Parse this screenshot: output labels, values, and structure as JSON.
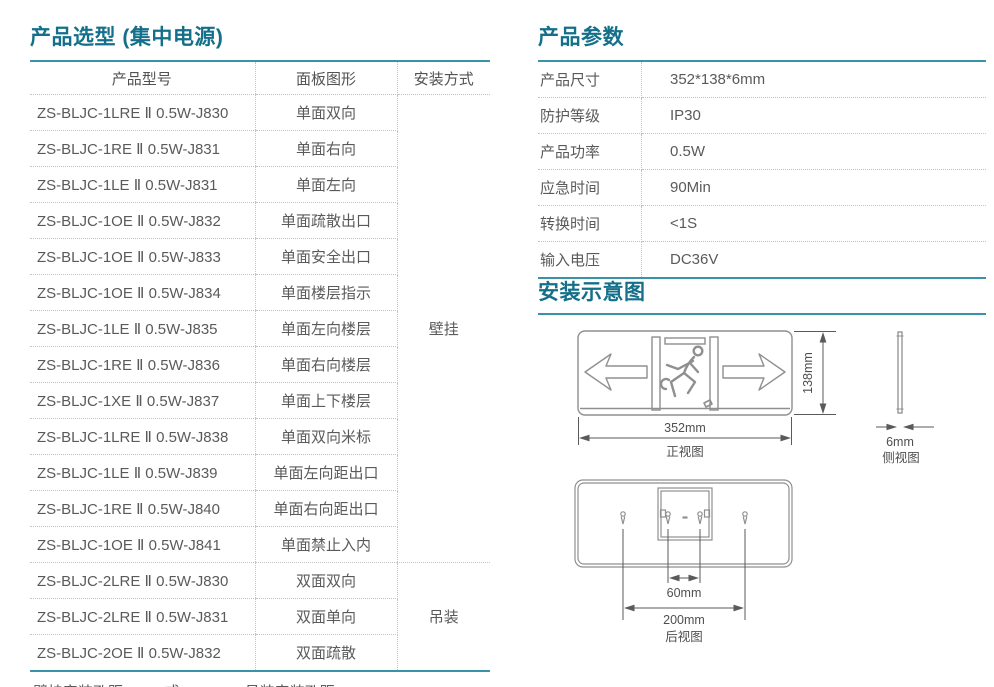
{
  "accent": {
    "title_color": "#14708a",
    "rule_color": "#3a92a8"
  },
  "selection": {
    "title": "产品选型 (集中电源)",
    "columns": [
      "产品型号",
      "面板图形",
      "安装方式"
    ],
    "rows": [
      {
        "model": "ZS-BLJC-1LRE Ⅱ 0.5W-J830",
        "panel": "单面双向"
      },
      {
        "model": "ZS-BLJC-1RE Ⅱ 0.5W-J831",
        "panel": "单面右向"
      },
      {
        "model": "ZS-BLJC-1LE Ⅱ 0.5W-J831",
        "panel": "单面左向"
      },
      {
        "model": "ZS-BLJC-1OE Ⅱ 0.5W-J832",
        "panel": "单面疏散出口"
      },
      {
        "model": "ZS-BLJC-1OE Ⅱ 0.5W-J833",
        "panel": "单面安全出口"
      },
      {
        "model": "ZS-BLJC-1OE Ⅱ 0.5W-J834",
        "panel": "单面楼层指示"
      },
      {
        "model": "ZS-BLJC-1LE Ⅱ 0.5W-J835",
        "panel": "单面左向楼层"
      },
      {
        "model": "ZS-BLJC-1RE Ⅱ 0.5W-J836",
        "panel": "单面右向楼层"
      },
      {
        "model": "ZS-BLJC-1XE Ⅱ 0.5W-J837",
        "panel": "单面上下楼层"
      },
      {
        "model": "ZS-BLJC-1LRE Ⅱ 0.5W-J838",
        "panel": "单面双向米标"
      },
      {
        "model": "ZS-BLJC-1LE Ⅱ 0.5W-J839",
        "panel": "单面左向距出口"
      },
      {
        "model": "ZS-BLJC-1RE Ⅱ 0.5W-J840",
        "panel": "单面右向距出口"
      },
      {
        "model": "ZS-BLJC-1OE Ⅱ 0.5W-J841",
        "panel": "单面禁止入内"
      },
      {
        "model": "ZS-BLJC-2LRE Ⅱ 0.5W-J830",
        "panel": "双面双向"
      },
      {
        "model": "ZS-BLJC-2LRE Ⅱ 0.5W-J831",
        "panel": "双面单向"
      },
      {
        "model": "ZS-BLJC-2OE Ⅱ 0.5W-J832",
        "panel": "双面疏散"
      }
    ],
    "mount_groups": [
      {
        "label": "壁挂",
        "span": 13
      },
      {
        "label": "吊装",
        "span": 3
      }
    ],
    "footnote": "壁挂安装孔距60mm或200mm；吊装安装孔距230mm"
  },
  "parameters": {
    "title": "产品参数",
    "rows": [
      {
        "label": "产品尺寸",
        "value": "352*138*6mm"
      },
      {
        "label": "防护等级",
        "value": "IP30"
      },
      {
        "label": "产品功率",
        "value": "0.5W"
      },
      {
        "label": "应急时间",
        "value": "90Min"
      },
      {
        "label": "转换时间",
        "value": "<1S"
      },
      {
        "label": "输入电压",
        "value": "DC36V"
      }
    ]
  },
  "installation": {
    "title": "安装示意图",
    "front_view": {
      "width_label": "352mm",
      "height_label": "138mm",
      "caption": "正视图"
    },
    "side_view": {
      "thickness_label": "6mm",
      "caption": "侧视图"
    },
    "rear_view": {
      "inner_hole_label": "60mm",
      "outer_hole_label": "200mm",
      "caption": "后视图"
    }
  }
}
